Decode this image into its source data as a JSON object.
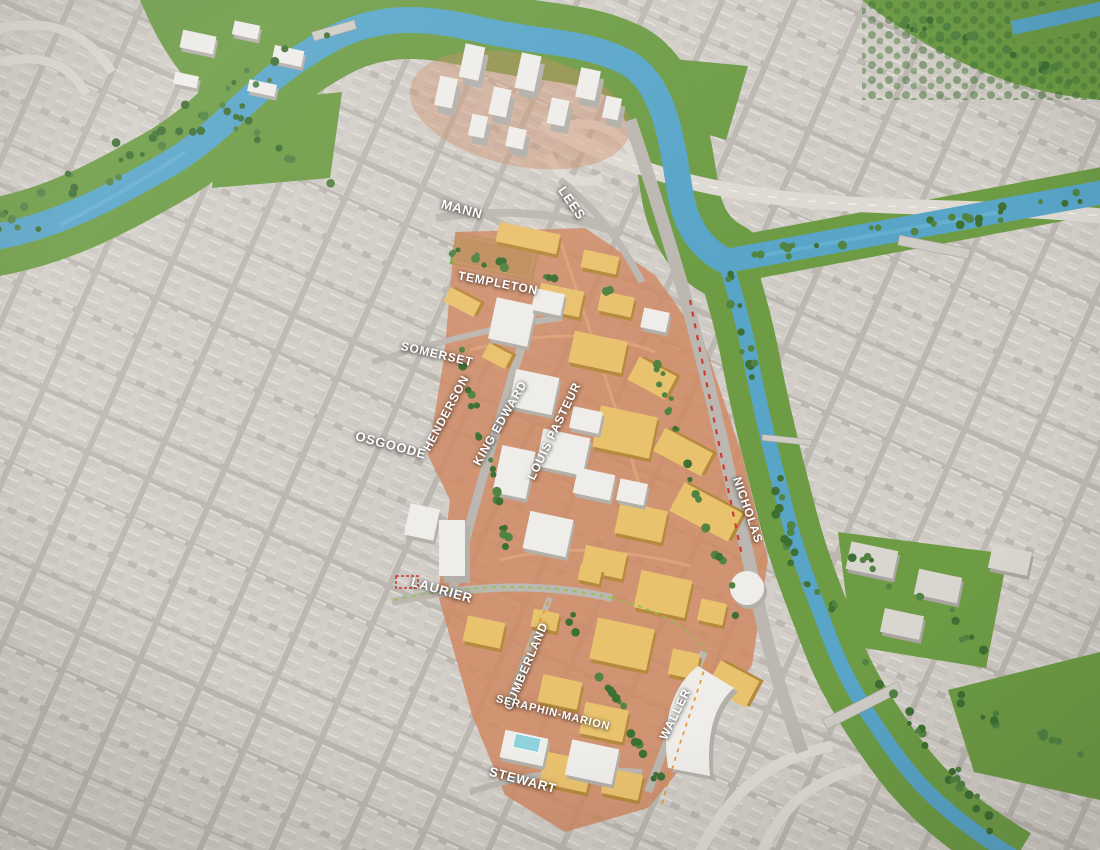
{
  "map": {
    "description": "3D aerial rendering of a campus master plan: tan-highlighted campus buildings along a diagonal spine between a gray city grid, a winding blue river with green banks, parks and a highway",
    "street_labels": [
      {
        "text": "MANN",
        "x": 462,
        "y": 209,
        "rotation": 15,
        "size": 13
      },
      {
        "text": "LEES",
        "x": 572,
        "y": 203,
        "rotation": 55,
        "size": 13
      },
      {
        "text": "TEMPLETON",
        "x": 498,
        "y": 283,
        "rotation": 11,
        "size": 12
      },
      {
        "text": "SOMERSET",
        "x": 437,
        "y": 354,
        "rotation": 13,
        "size": 12
      },
      {
        "text": "HENDERSON",
        "x": 446,
        "y": 413,
        "rotation": -62,
        "size": 12
      },
      {
        "text": "OSGOODE",
        "x": 391,
        "y": 445,
        "rotation": 15,
        "size": 13
      },
      {
        "text": "KING EDWARD",
        "x": 500,
        "y": 423,
        "rotation": -60,
        "size": 12
      },
      {
        "text": "LOUIS PASTEUR",
        "x": 554,
        "y": 431,
        "rotation": -64,
        "size": 12
      },
      {
        "text": "NICHOLAS",
        "x": 748,
        "y": 510,
        "rotation": 71,
        "size": 12
      },
      {
        "text": "LAURIER",
        "x": 442,
        "y": 590,
        "rotation": 16,
        "size": 13
      },
      {
        "text": "CUMBERLAND",
        "x": 526,
        "y": 666,
        "rotation": -67,
        "size": 12
      },
      {
        "text": "SERAPHIN-MARION",
        "x": 553,
        "y": 713,
        "rotation": 14,
        "size": 11
      },
      {
        "text": "WALLER",
        "x": 675,
        "y": 714,
        "rotation": -64,
        "size": 12
      },
      {
        "text": "STEWART",
        "x": 523,
        "y": 780,
        "rotation": 15,
        "size": 13
      }
    ],
    "colors": {
      "ground": "#d7d2cb",
      "road": "#bcb7b0",
      "block": "#d3cec7",
      "building_gray": "#c9c5c0",
      "building_gray_shadow": "#a8a49d",
      "water": "#58a5c8",
      "park": "#6d9c45",
      "field": "#6faf42",
      "tree_dark": "#3e6f33",
      "tree_light": "#518343",
      "campus_ground": "#cf8a64",
      "campus_yellow_top": "#e9c26e",
      "campus_yellow_side": "#b68a3e",
      "white_top": "#efedea",
      "white_side": "#b3afa9",
      "highway": "#dedad3",
      "transit_red": "#cc3b2f",
      "route_green": "#8bc34a",
      "route_orange": "#e8922a",
      "pool": "#8fd2de",
      "label": "#ffffff"
    }
  }
}
